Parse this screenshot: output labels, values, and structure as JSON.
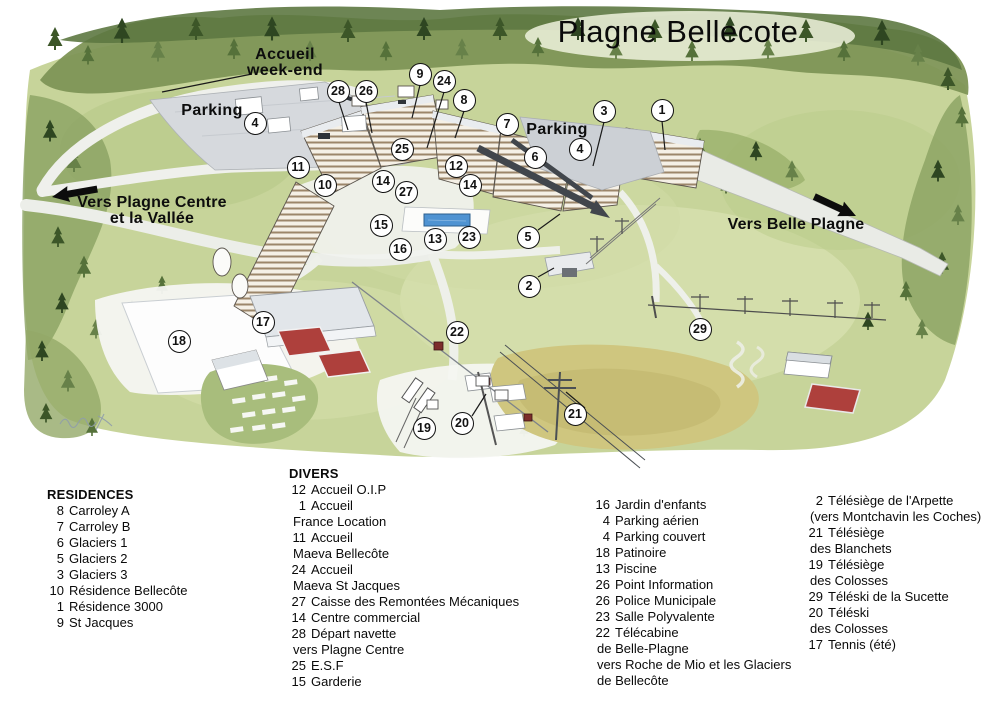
{
  "title": "Plagne Bellecote",
  "colors": {
    "ink": "#111111",
    "meadow_green": "#c7d49a",
    "forest_green": "#55713a",
    "court_red": "#ae403c",
    "pool_blue": "#4f93d2",
    "road_grey": "#d6d9dd",
    "slope_tan": "#cfc67f"
  },
  "map": {
    "labels": [
      {
        "id": "label-accueil-weekend",
        "lines": [
          "Accueil",
          "week-end"
        ],
        "x": 285,
        "y": 47,
        "role": "place"
      },
      {
        "id": "label-parking-west",
        "lines": [
          "Parking"
        ],
        "x": 212,
        "y": 103,
        "role": "place"
      },
      {
        "id": "label-parking-center",
        "lines": [
          "Parking"
        ],
        "x": 557,
        "y": 122,
        "role": "place"
      },
      {
        "id": "label-vers-plagne-centre",
        "lines": [
          "Vers Plagne Centre",
          "et la Vallée"
        ],
        "x": 152,
        "y": 195,
        "role": "direction"
      },
      {
        "id": "label-vers-belle-plagne",
        "lines": [
          "Vers Belle Plagne"
        ],
        "x": 796,
        "y": 217,
        "role": "direction"
      }
    ],
    "markers": [
      {
        "n": "1",
        "x": 662,
        "y": 110
      },
      {
        "n": "2",
        "x": 529,
        "y": 286
      },
      {
        "n": "3",
        "x": 604,
        "y": 111
      },
      {
        "n": "4",
        "x": 255,
        "y": 123
      },
      {
        "n": "4",
        "x": 580,
        "y": 149
      },
      {
        "n": "5",
        "x": 528,
        "y": 237
      },
      {
        "n": "6",
        "x": 535,
        "y": 157
      },
      {
        "n": "7",
        "x": 507,
        "y": 124
      },
      {
        "n": "8",
        "x": 464,
        "y": 100
      },
      {
        "n": "9",
        "x": 420,
        "y": 74
      },
      {
        "n": "10",
        "x": 325,
        "y": 185
      },
      {
        "n": "11",
        "x": 298,
        "y": 167
      },
      {
        "n": "12",
        "x": 456,
        "y": 166
      },
      {
        "n": "13",
        "x": 435,
        "y": 239
      },
      {
        "n": "14",
        "x": 383,
        "y": 181
      },
      {
        "n": "14",
        "x": 470,
        "y": 185
      },
      {
        "n": "15",
        "x": 381,
        "y": 225
      },
      {
        "n": "16",
        "x": 400,
        "y": 249
      },
      {
        "n": "17",
        "x": 263,
        "y": 322
      },
      {
        "n": "18",
        "x": 179,
        "y": 341
      },
      {
        "n": "19",
        "x": 424,
        "y": 428
      },
      {
        "n": "20",
        "x": 462,
        "y": 423
      },
      {
        "n": "21",
        "x": 575,
        "y": 414
      },
      {
        "n": "22",
        "x": 457,
        "y": 332
      },
      {
        "n": "23",
        "x": 469,
        "y": 237
      },
      {
        "n": "24",
        "x": 444,
        "y": 81
      },
      {
        "n": "25",
        "x": 402,
        "y": 149
      },
      {
        "n": "26",
        "x": 366,
        "y": 91
      },
      {
        "n": "27",
        "x": 406,
        "y": 192
      },
      {
        "n": "28",
        "x": 338,
        "y": 91
      },
      {
        "n": "29",
        "x": 700,
        "y": 329
      }
    ]
  },
  "legend": {
    "columns": [
      {
        "title": "RESIDENCES",
        "items": [
          {
            "num": "8",
            "text": "Carroley A"
          },
          {
            "num": "7",
            "text": "Carroley B"
          },
          {
            "num": "6",
            "text": "Glaciers 1"
          },
          {
            "num": "5",
            "text": "Glaciers 2"
          },
          {
            "num": "3",
            "text": "Glaciers 3"
          },
          {
            "num": "10",
            "text": "Résidence Bellecôte"
          },
          {
            "num": "1",
            "text": "Résidence 3000"
          },
          {
            "num": "9",
            "text": "St Jacques"
          }
        ]
      },
      {
        "title": "DIVERS",
        "items": [
          {
            "num": "12",
            "text": "Accueil O.I.P"
          },
          {
            "num": "1",
            "text": "Accueil"
          },
          {
            "num": "",
            "text": "France Location"
          },
          {
            "num": "11",
            "text": "Accueil"
          },
          {
            "num": "",
            "text": "Maeva Bellecôte"
          },
          {
            "num": "24",
            "text": "Accueil"
          },
          {
            "num": "",
            "text": "Maeva St Jacques"
          },
          {
            "num": "27",
            "text": "Caisse des Remontées Mécaniques"
          },
          {
            "num": "14",
            "text": "Centre commercial"
          },
          {
            "num": "28",
            "text": "Départ navette"
          },
          {
            "num": "",
            "text": "vers Plagne Centre"
          },
          {
            "num": "25",
            "text": "E.S.F"
          },
          {
            "num": "15",
            "text": "Garderie"
          }
        ]
      },
      {
        "title": "",
        "items": [
          {
            "num": "16",
            "text": "Jardin d'enfants"
          },
          {
            "num": "4",
            "text": "Parking aérien"
          },
          {
            "num": "4",
            "text": "Parking couvert"
          },
          {
            "num": "18",
            "text": "Patinoire"
          },
          {
            "num": "13",
            "text": "Piscine"
          },
          {
            "num": "26",
            "text": "Point Information"
          },
          {
            "num": "26",
            "text": "Police Municipale"
          },
          {
            "num": "23",
            "text": "Salle Polyvalente"
          },
          {
            "num": "22",
            "text": "Télécabine"
          },
          {
            "num": "",
            "text": "de Belle-Plagne"
          },
          {
            "num": "",
            "text": "vers Roche de Mio et les Glaciers"
          },
          {
            "num": "",
            "text": "de Bellecôte"
          }
        ]
      },
      {
        "title": "",
        "items": [
          {
            "num": "2",
            "text": "Télésiège de l'Arpette"
          },
          {
            "num": "",
            "text": "(vers Montchavin les Coches)"
          },
          {
            "num": "21",
            "text": "Télésiège"
          },
          {
            "num": "",
            "text": "des Blanchets"
          },
          {
            "num": "19",
            "text": "Télésiège"
          },
          {
            "num": "",
            "text": "des Colosses"
          },
          {
            "num": "29",
            "text": "Téléski de la Sucette"
          },
          {
            "num": "20",
            "text": "Téléski"
          },
          {
            "num": "",
            "text": "des Colosses"
          },
          {
            "num": "17",
            "text": "Tennis (été)"
          }
        ]
      }
    ]
  }
}
